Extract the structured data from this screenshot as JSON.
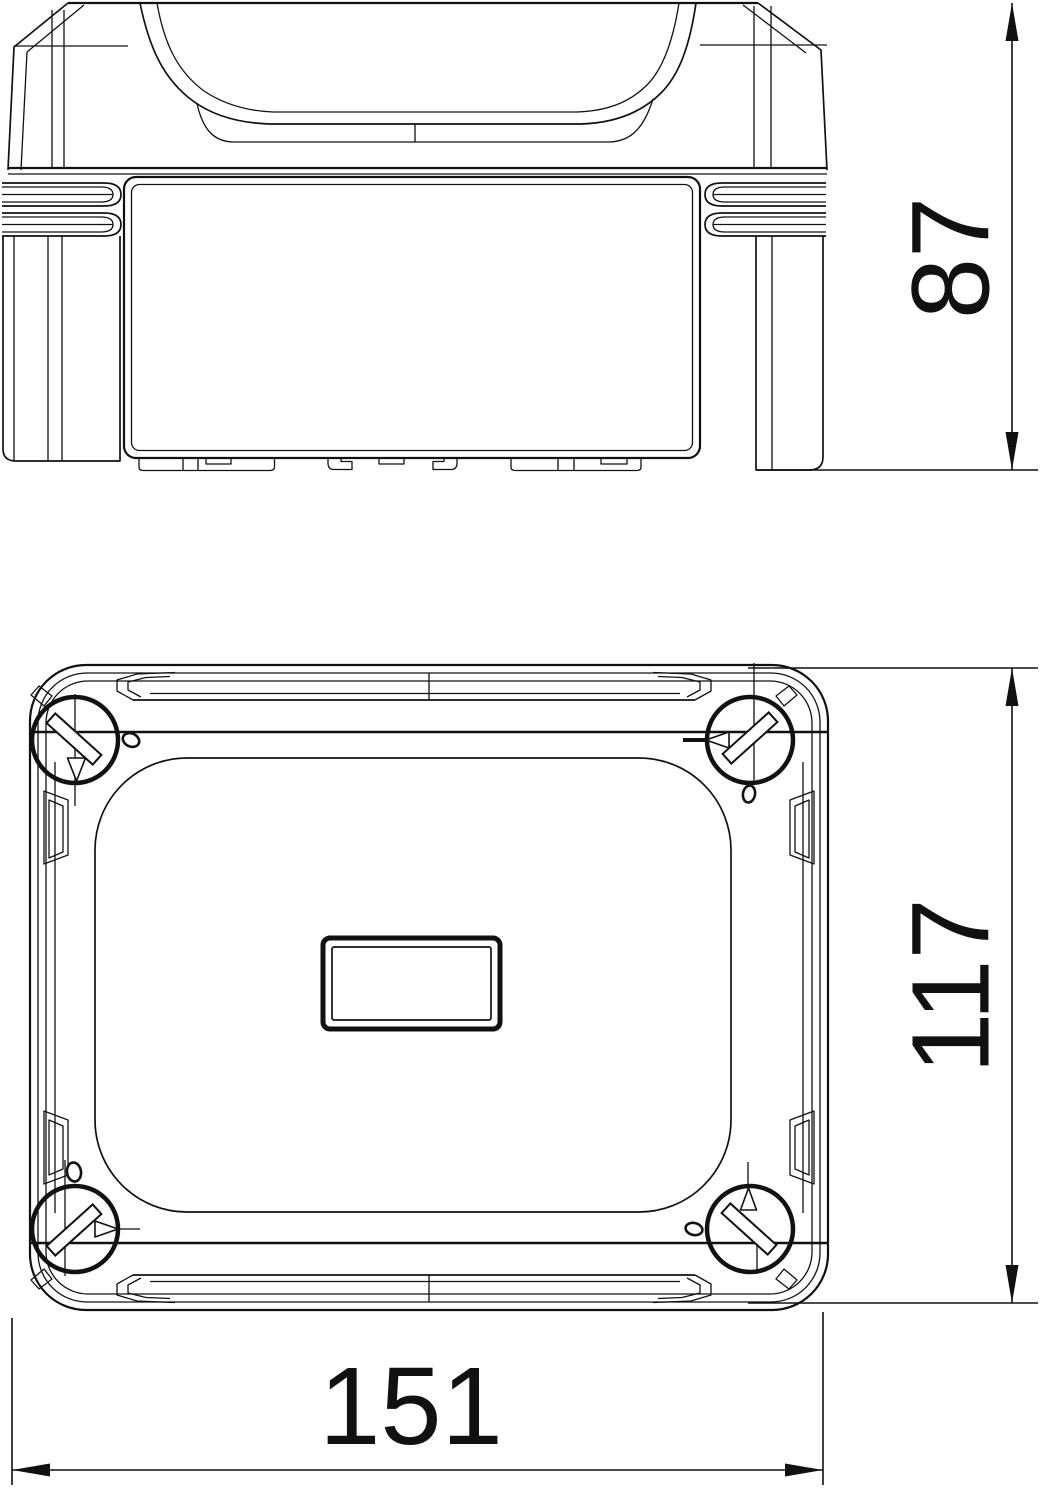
{
  "drawing": {
    "kind": "technical dimension drawing",
    "subject": "plastic junction box enclosure with handle lid and four corner quick-release screws",
    "background_color": "#ffffff",
    "line_color": "#111111",
    "views": [
      {
        "id": "side-elevation",
        "description": "front/side elevation of closed box with recessed lid handle, side latch ribs and mounting feet"
      },
      {
        "id": "bottom-plan",
        "description": "plan view of lid with four corner screw circles, slot marks, direction triangles and central label field"
      }
    ],
    "dimensions": {
      "height": {
        "value": "87",
        "orientation": "vertical",
        "view": "side-elevation",
        "side": "right"
      },
      "depth": {
        "value": "117",
        "orientation": "vertical",
        "view": "bottom-plan",
        "side": "right"
      },
      "width": {
        "value": "151",
        "orientation": "horizontal",
        "view": "bottom-plan",
        "side": "bottom"
      }
    }
  }
}
